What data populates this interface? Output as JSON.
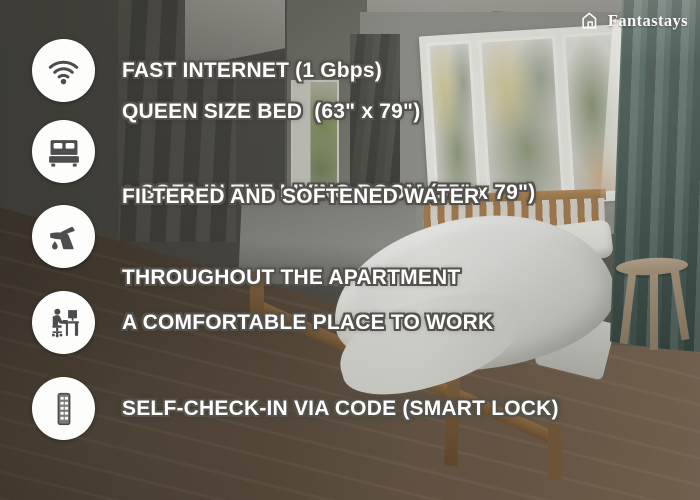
{
  "brand": {
    "name": "Fantastays",
    "logo_icon": "house-icon"
  },
  "features": [
    {
      "id": "fast-internet",
      "icon": "wifi-icon",
      "lines": [
        "FAST INTERNET (1 Gbps)"
      ]
    },
    {
      "id": "queen-bed",
      "icon": "bed-icon",
      "lines": [
        "QUEEN SIZE BED  (63\" x 79\")",
        "+ SOFA IN THE LIVING ROOM (55\" x 79\")"
      ]
    },
    {
      "id": "filtered-water",
      "icon": "faucet-icon",
      "lines": [
        "FILTERED AND SOFTENED WATER",
        "THROUGHOUT THE APARTMENT"
      ]
    },
    {
      "id": "workspace",
      "icon": "desk-workstation-icon",
      "lines": [
        "A COMFORTABLE PLACE TO WORK"
      ]
    },
    {
      "id": "self-check-in",
      "icon": "keypad-icon",
      "lines": [
        "SELF-CHECK-IN VIA CODE (SMART LOCK)"
      ]
    }
  ],
  "colors": {
    "feature_text": "#ffffff",
    "text_outline": "#55524c",
    "icon_circle_bg": "#fdfdfc",
    "icon_glyph": "#4d4d4d",
    "logo_text": "#fafaf7",
    "teal_curtain": "#516862",
    "wood_floor": "#5d4e41",
    "bed_frame_wood": "#8f6c45"
  }
}
